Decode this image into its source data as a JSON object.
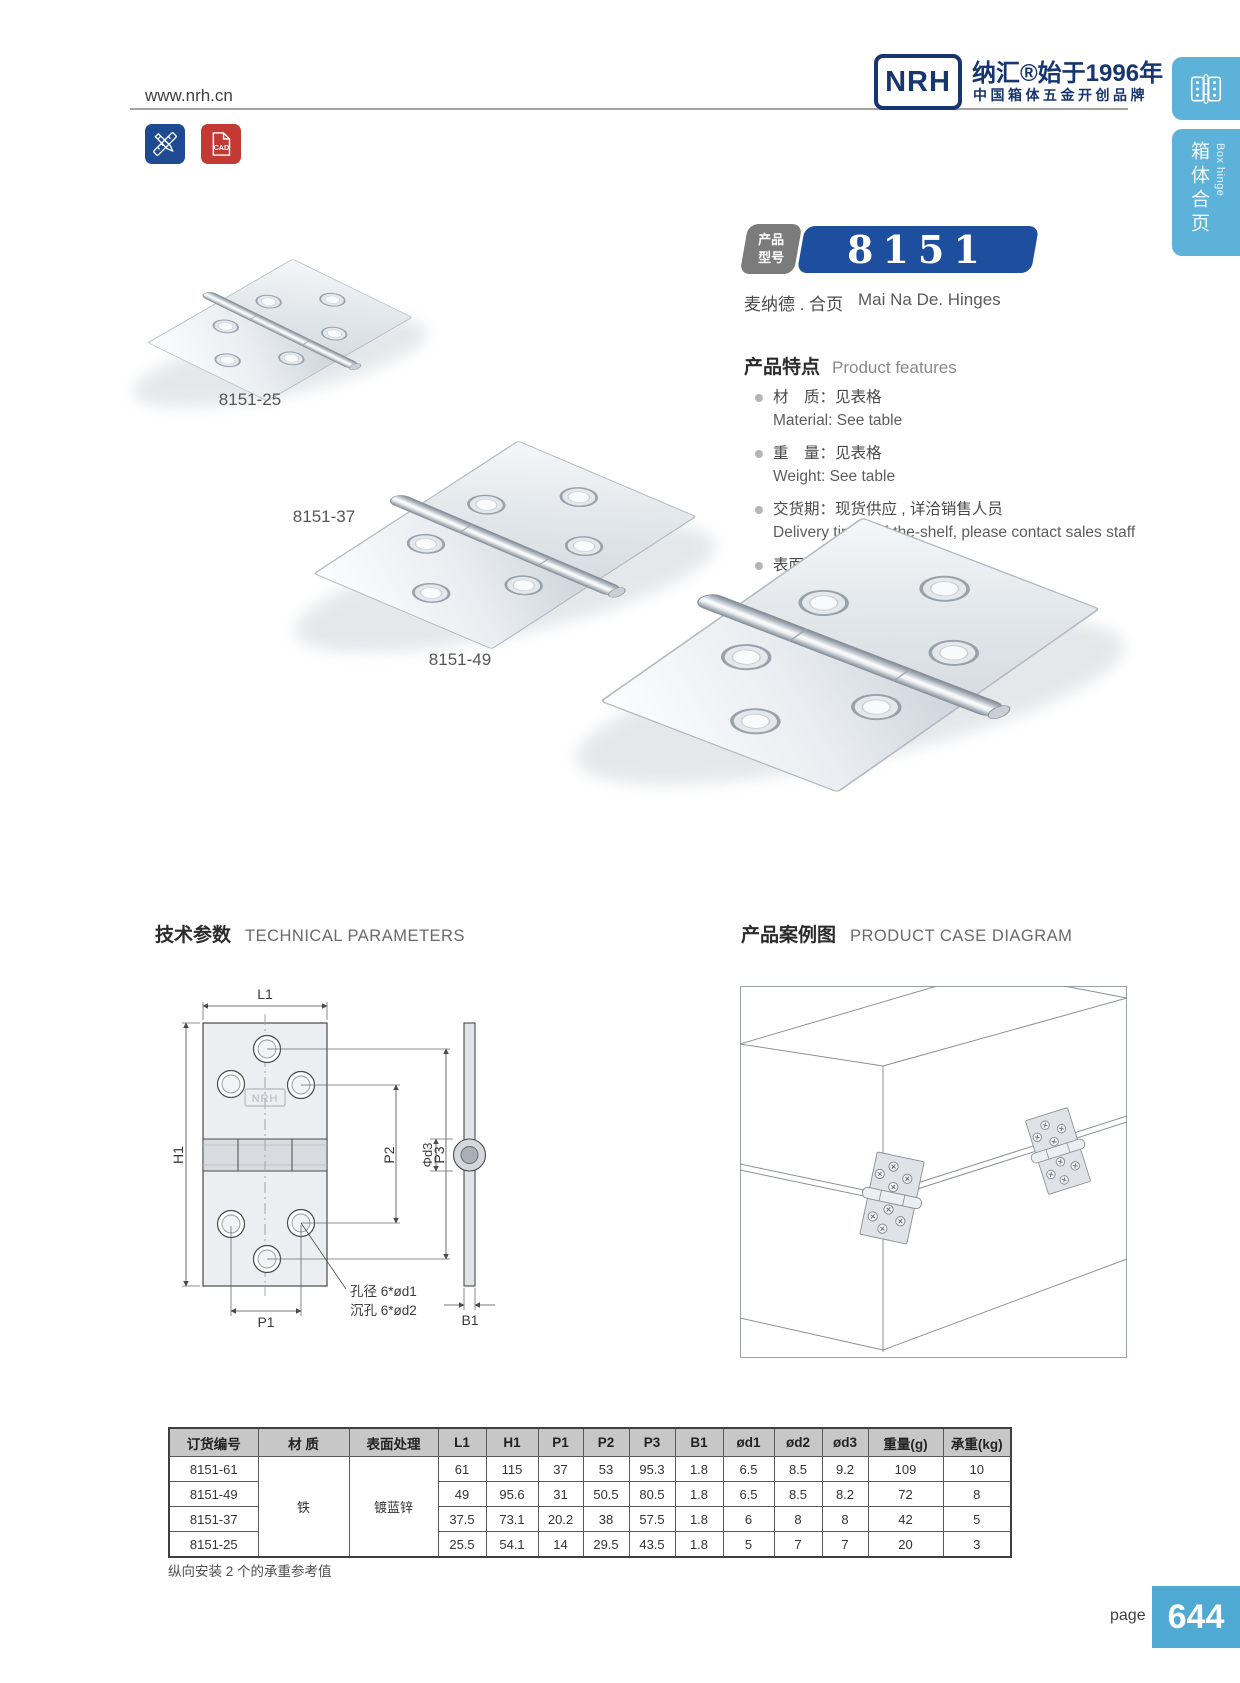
{
  "header": {
    "url": "www.nrh.cn",
    "logo_text": "NRH",
    "brand_line1": "纳汇®始于1996年",
    "brand_line2": "中国箱体五金开创品牌"
  },
  "toolbar": {
    "cad_label": "CAD"
  },
  "side_tabs": {
    "category_zh": "箱体合页",
    "category_en": "Box hinge"
  },
  "product": {
    "badge_label_line1": "产品",
    "badge_label_line2": "型号",
    "model": "8151",
    "name_zh": "麦纳德 . 合页",
    "name_en": "Mai Na De. Hinges"
  },
  "features": {
    "title_zh": "产品特点",
    "title_en": "Product features",
    "items": [
      {
        "zh": "材　质：见表格",
        "en": "Material: See table"
      },
      {
        "zh": "重　量：见表格",
        "en": "Weight: See table"
      },
      {
        "zh": "交货期：现货供应 , 详洽销售人员",
        "en": "Delivery time: off-the-shelf, please contact sales staff"
      },
      {
        "zh": "表面处理：见表格",
        "en": "Surface treatment：See table"
      },
      {
        "zh": "用途：木箱、军用箱",
        "en": "Application: Wooden box, military box"
      },
      {
        "zh": "承重力：见表格",
        "en": "Loading capacity: See table"
      }
    ]
  },
  "gallery": {
    "labels": [
      "8151-25",
      "8151-37",
      "8151-49"
    ]
  },
  "sections": {
    "tech_zh": "技术参数",
    "tech_en": "TECHNICAL PARAMETERS",
    "case_zh": "产品案例图",
    "case_en": "PRODUCT CASE DIAGRAM"
  },
  "drawing": {
    "labels": {
      "l1": "L1",
      "h1": "H1",
      "p1": "P1",
      "p2": "P2",
      "p3": "P3",
      "b1": "B1",
      "d3": "Φd3",
      "hole1": "孔径 6*ød1",
      "hole2": "沉孔 6*ød2",
      "logo": "NRH"
    }
  },
  "table": {
    "headers": [
      "订货编号",
      "材  质",
      "表面处理",
      "L1",
      "H1",
      "P1",
      "P2",
      "P3",
      "B1",
      "ød1",
      "ød2",
      "ød3",
      "重量(g)",
      "承重(kg)"
    ],
    "material": "铁",
    "surface": "镀蓝锌",
    "rows": [
      {
        "model": "8151-61",
        "l1": "61",
        "h1": "115",
        "p1": "37",
        "p2": "53",
        "p3": "95.3",
        "b1": "1.8",
        "d1": "6.5",
        "d2": "8.5",
        "d3": "9.2",
        "weight": "109",
        "load": "10"
      },
      {
        "model": "8151-49",
        "l1": "49",
        "h1": "95.6",
        "p1": "31",
        "p2": "50.5",
        "p3": "80.5",
        "b1": "1.8",
        "d1": "6.5",
        "d2": "8.5",
        "d3": "8.2",
        "weight": "72",
        "load": "8"
      },
      {
        "model": "8151-37",
        "l1": "37.5",
        "h1": "73.1",
        "p1": "20.2",
        "p2": "38",
        "p3": "57.5",
        "b1": "1.8",
        "d1": "6",
        "d2": "8",
        "d3": "8",
        "weight": "42",
        "load": "5"
      },
      {
        "model": "8151-25",
        "l1": "25.5",
        "h1": "54.1",
        "p1": "14",
        "p2": "29.5",
        "p3": "43.5",
        "b1": "1.8",
        "d1": "5",
        "d2": "7",
        "d3": "7",
        "weight": "20",
        "load": "3"
      }
    ],
    "footnote": "纵向安装 2 个的承重参考值"
  },
  "footer": {
    "page_label": "page",
    "page_number": "644"
  },
  "colors": {
    "navy": "#17356e",
    "badge_blue": "#1e4f9e",
    "light_blue": "#5cb2d9",
    "page_blue": "#4fa9d3",
    "cad_red": "#c23a33",
    "tool_blue": "#1e4a92",
    "table_header": "#c7c7c7"
  }
}
